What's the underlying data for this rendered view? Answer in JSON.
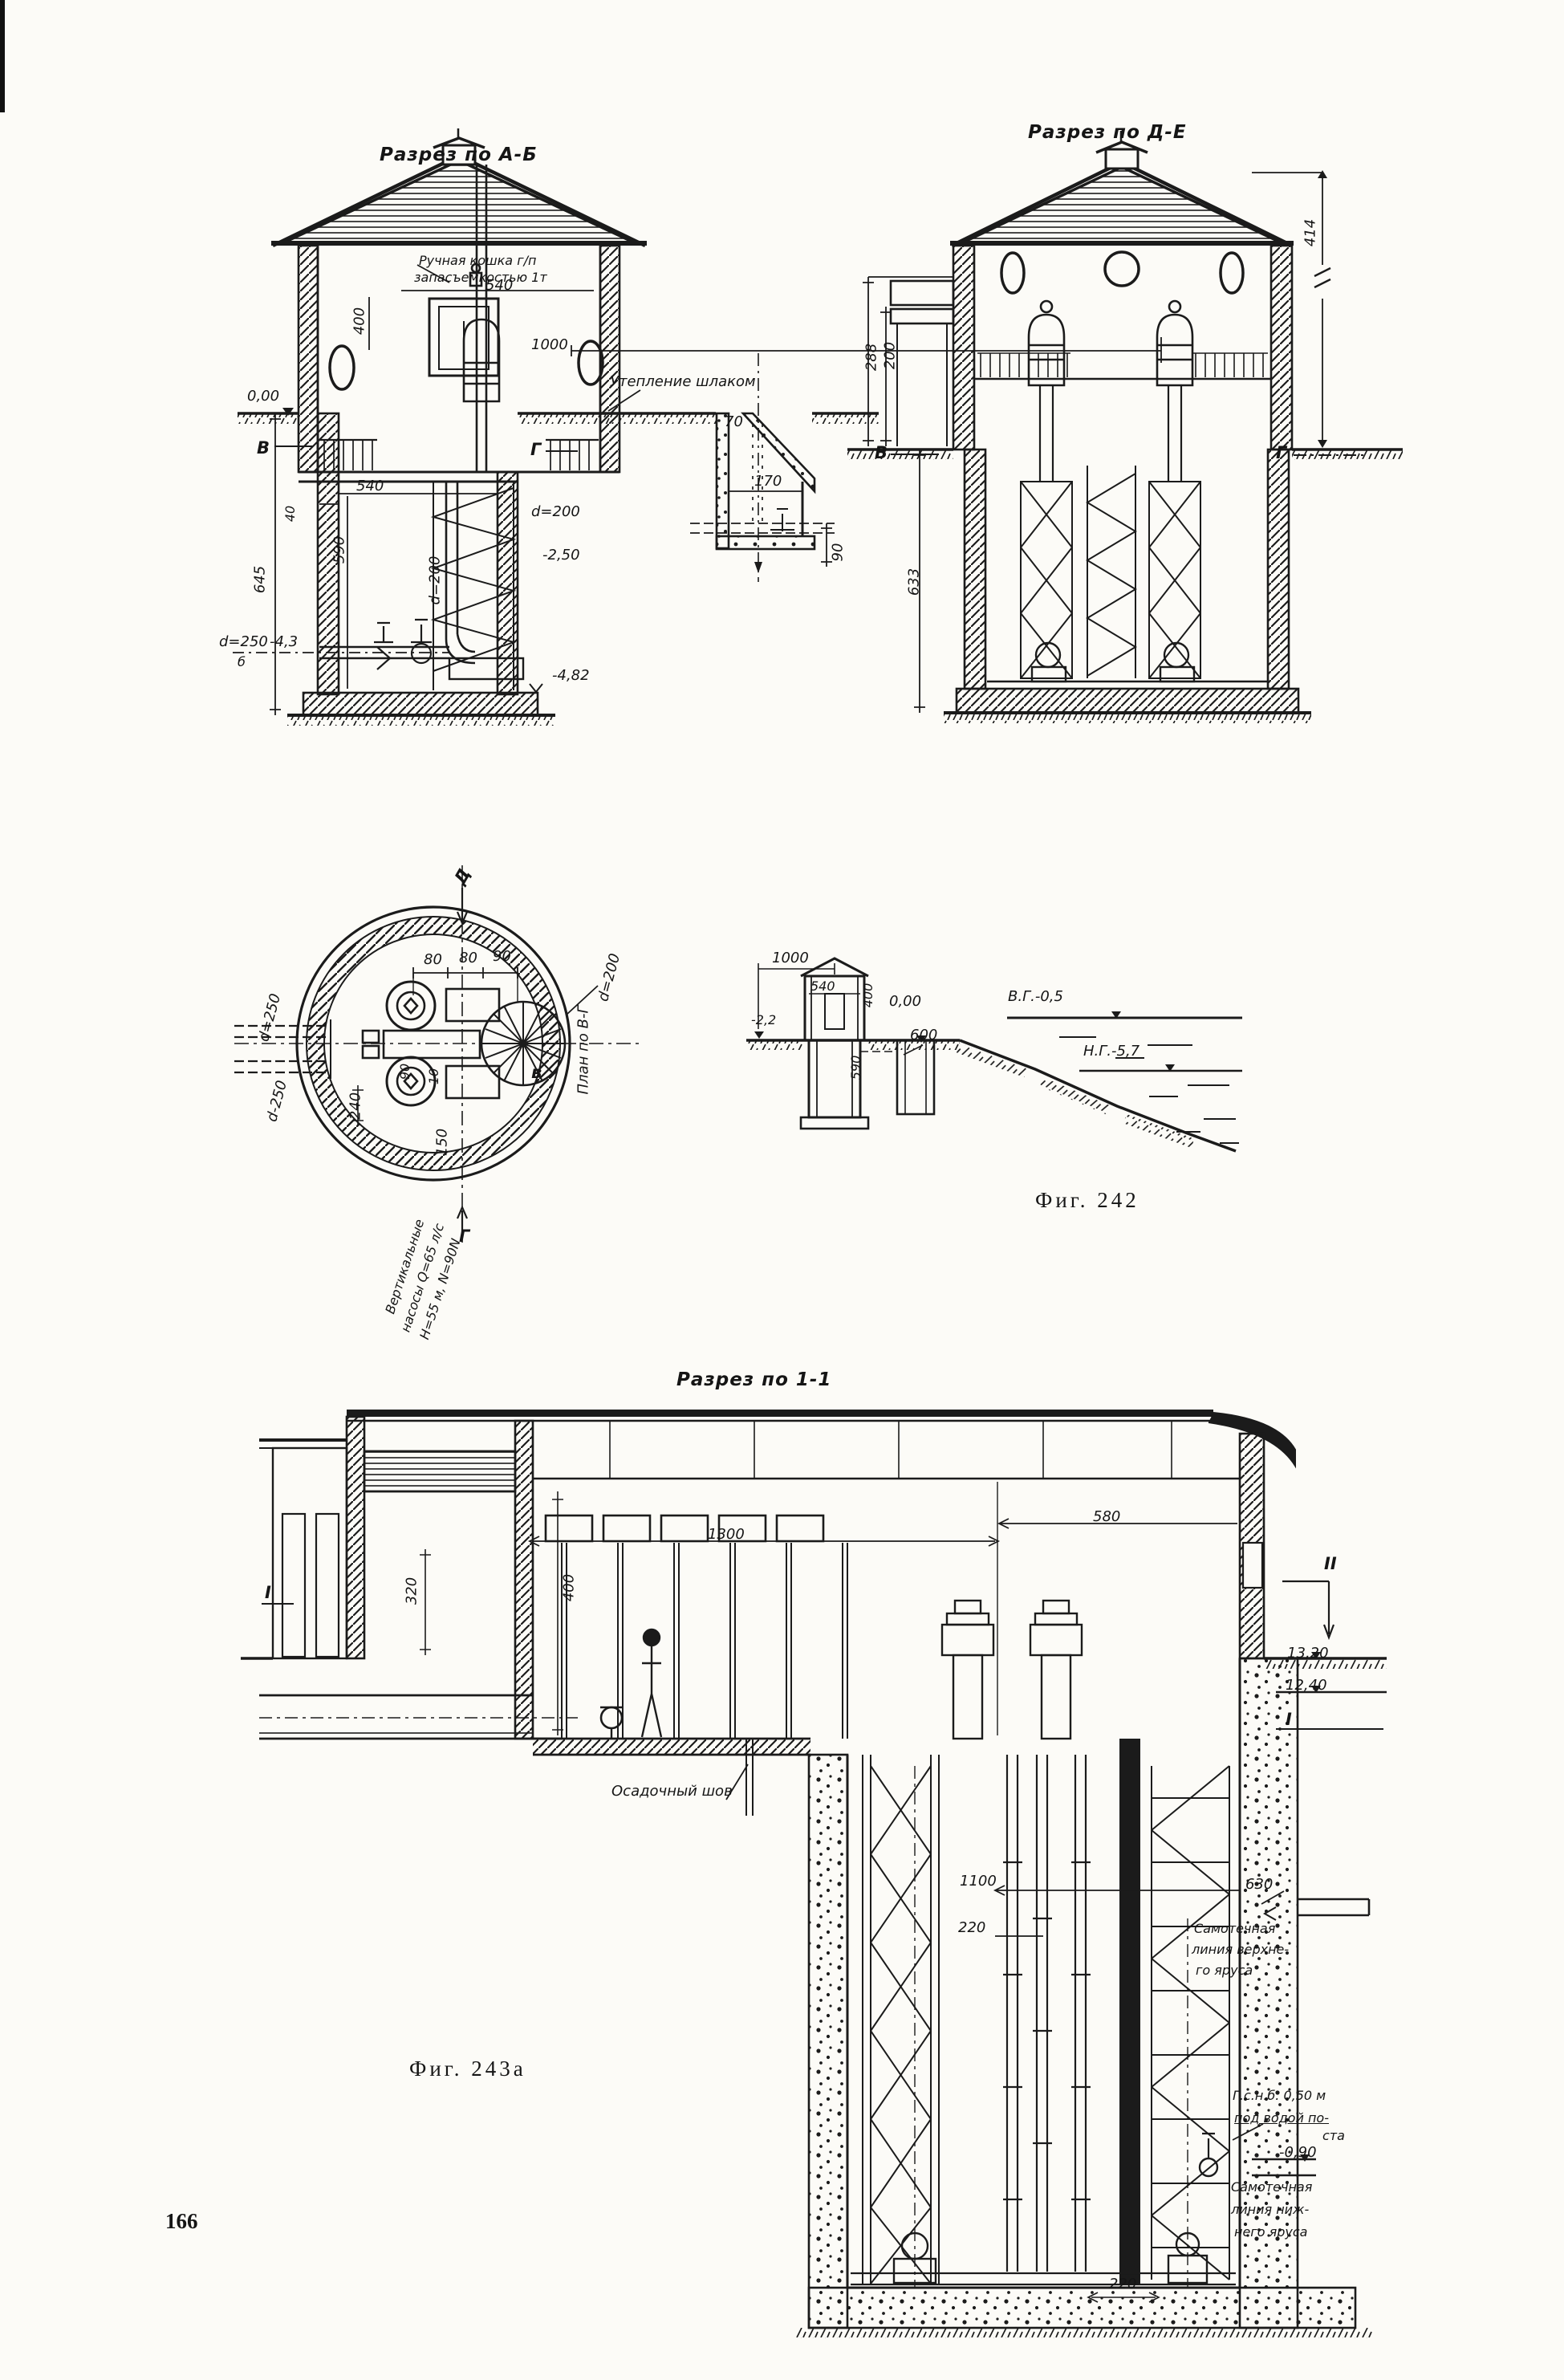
{
  "page": {
    "number": "166"
  },
  "fig242": {
    "caption": "Фиг. 242",
    "ab": {
      "title": "Разрез по А-Б",
      "crane1": "Ручная кошка г/п",
      "crane2": "запасъемкостью 1т",
      "dim540top": "540",
      "dim400": "400",
      "dim1000": "1000",
      "insulation": "Утепление шлаком",
      "level000": "0,00",
      "markerV": "В",
      "markerG": "Г",
      "dim540": "540",
      "dim40": "40",
      "dim590": "590",
      "dim645": "645",
      "d250": "d=250",
      "level43": "-4,3",
      "markerB": "б",
      "d200pipe": "d=200",
      "level482": "-4,82",
      "pit": {
        "d200": "d=200",
        "level250": "-2,50",
        "dim70": "70",
        "dim170": "170",
        "dim90": "90"
      }
    },
    "de": {
      "title": "Разрез по Д-Е",
      "dim288": "288",
      "dim200": "200",
      "dim414": "414",
      "dim633": "633",
      "markerV": "В",
      "markerG": "Г"
    },
    "plan": {
      "markerD": "Д",
      "markerG": "Г",
      "markerVsm": "в",
      "planLabel": "План по В-Г",
      "dim80a": "80",
      "dim80b": "80",
      "dim90": "90",
      "d200": "d=200",
      "d250": "d=250",
      "d250b": "d-250",
      "dim240": "240",
      "dim90b": "90",
      "dim10": "10",
      "dim150": "150",
      "pump1": "Вертикальные",
      "pump2": "насосы Q=65 л/с",
      "pump3": "Н=55 м, N=90N"
    },
    "profile": {
      "dim1000": "1000",
      "dim540": "540",
      "dim400": "400",
      "level000": "0,00",
      "levelVG": "В.Г.-0,5",
      "levelNG": "Н.Г.-5,7",
      "dim590": "590",
      "dim600": "600",
      "level22": "-2,2"
    }
  },
  "fig243a": {
    "caption": "Фиг. 243а",
    "title": "Разрез по 1-1",
    "dim580": "580",
    "dim1300": "1300",
    "dim400": "400",
    "dim320": "320",
    "markerII": "II",
    "markerIleft": "I",
    "markerIright": "I",
    "level1320": "13,20",
    "level1240": "12,40",
    "joint": "Осадочный шов",
    "dim1100": "1100",
    "dim220": "220",
    "dim630": "630",
    "upper1": "Самотечная",
    "upper2": "линия верхне-",
    "upper3": "го яруса",
    "gsnb1": "Г.с.н.б. 0,50 м",
    "gsnb2": "под водой по-",
    "gsnb3": "ста",
    "level090": "-0,90",
    "lower1": "Самотечная",
    "lower2": "линия ниж-",
    "lower3": "него яруса",
    "dim220b": "220"
  }
}
